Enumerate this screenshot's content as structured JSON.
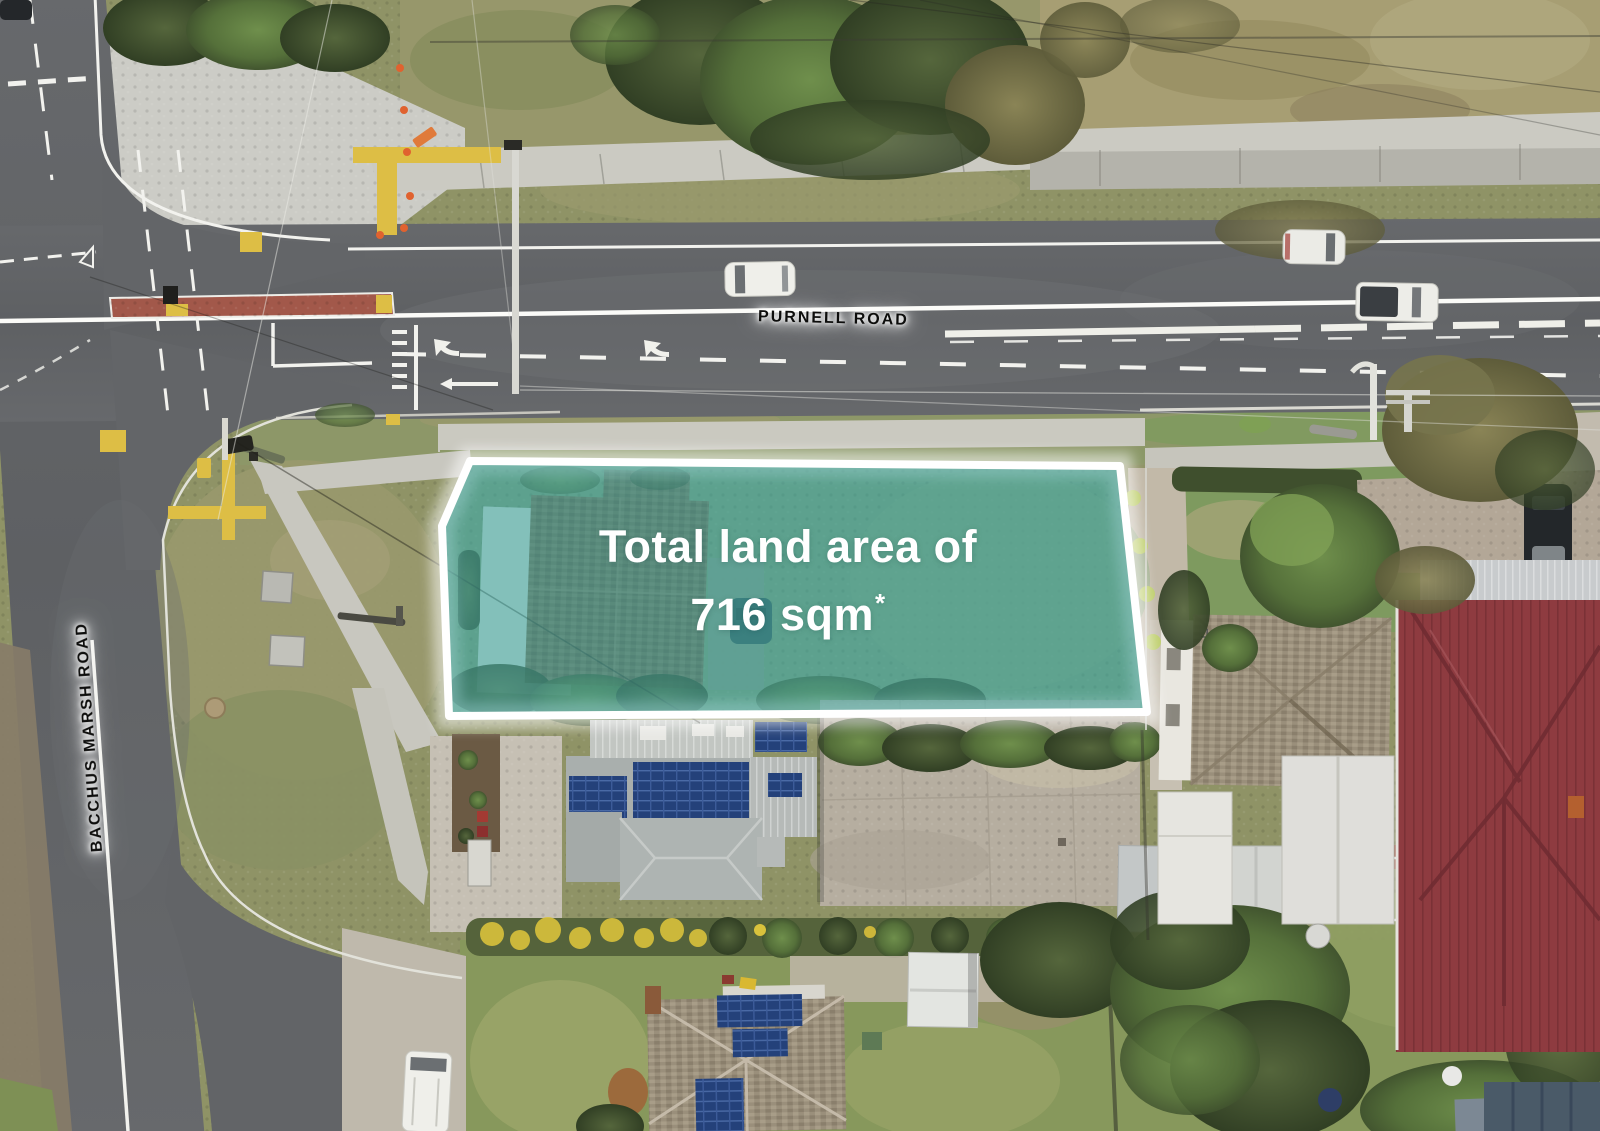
{
  "overlay": {
    "headline_line1": "Total land area of",
    "headline_value": "716 sqm",
    "headline_asterisk": "*",
    "fill_rgba": "rgba(64,160,153,0.58)",
    "border": "#FFFFFF"
  },
  "roads": {
    "purnell_label": "PURNELL ROAD",
    "bacchus_label": "BACCHUS MARSH ROAD"
  },
  "colors": {
    "asphalt": "#616366",
    "road_marking": "#F2F2EE",
    "kerb": "#DEDED6",
    "median_red": "#A2584A",
    "marking_yellow": "#DDBE45",
    "grass_olive": "#8F9366",
    "lawn_green": "#7E9A5F",
    "dry_grass": "#A79E73",
    "soil_brown": "#8A7B60",
    "tree_dark": "#44542F",
    "tree_green": "#68884A",
    "hedge_dark": "#4A592F",
    "flower_yellow": "#D9C23C",
    "concrete": "#CBCAC2",
    "concrete_warm": "#C2BAA9",
    "parking": "#B6AEA0",
    "building_gray": "#A9AFAD",
    "corrugated": "#C2C6C2",
    "solar_blue": "#24417A",
    "shingle_brown": "#7E6C54",
    "tile_tan": "#9A8F7B",
    "roof_red": "#8E3B40",
    "roof_white": "#E4E5E1",
    "car_white": "#EFEFEA",
    "car_dark": "#24282B"
  }
}
